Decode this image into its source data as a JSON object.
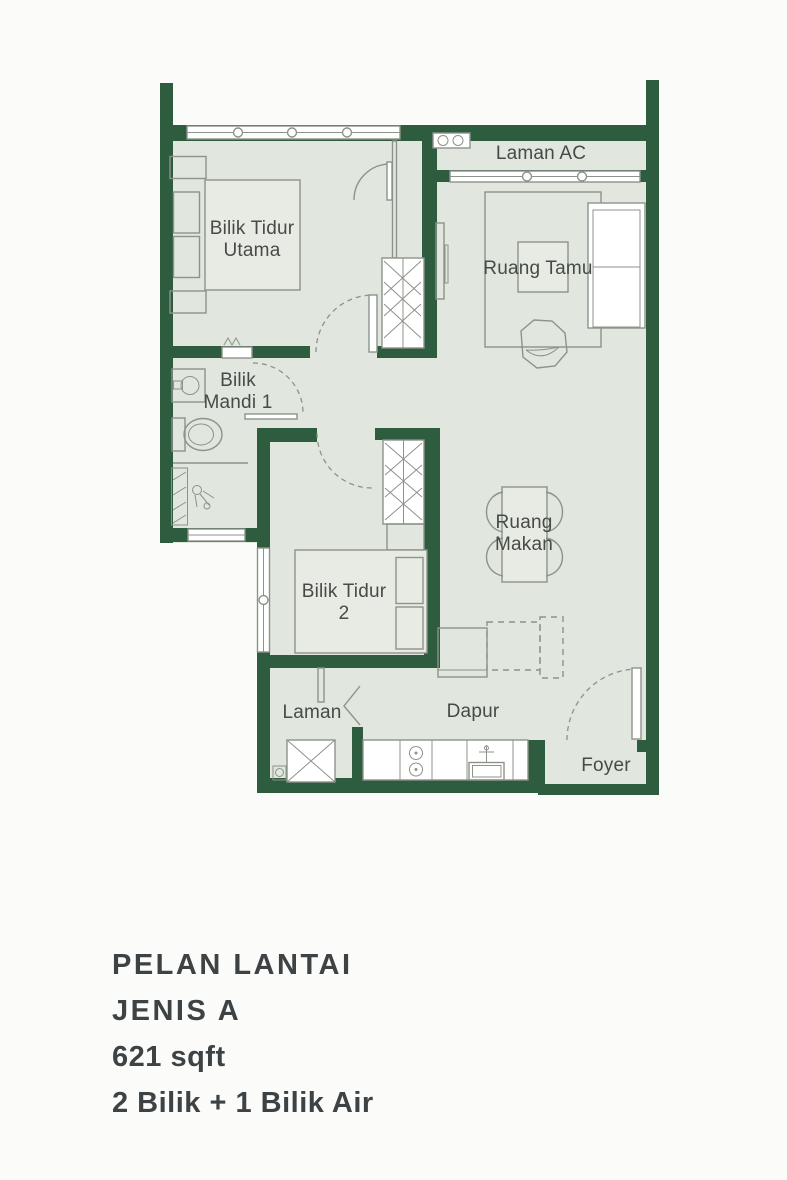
{
  "plan": {
    "rooms": [
      {
        "id": "bilik-tidur-utama",
        "label": "Bilik Tidur\nUtama"
      },
      {
        "id": "laman-ac",
        "label": "Laman AC"
      },
      {
        "id": "ruang-tamu",
        "label": "Ruang Tamu"
      },
      {
        "id": "bilik-mandi-1",
        "label": "Bilik\nMandi 1"
      },
      {
        "id": "ruang-makan",
        "label": "Ruang\nMakan"
      },
      {
        "id": "bilik-tidur-2",
        "label": "Bilik Tidur\n2"
      },
      {
        "id": "laman",
        "label": "Laman"
      },
      {
        "id": "dapur",
        "label": "Dapur"
      },
      {
        "id": "foyer",
        "label": "Foyer"
      }
    ],
    "colors": {
      "wall": "#2d5c3f",
      "floor": "#e1e6de",
      "outside": "#fbfcfa",
      "line": "#8c938a",
      "label": "#454c46",
      "caption": "#3d4245"
    }
  },
  "caption": {
    "title": "PELAN LANTAI",
    "type": "JENIS A",
    "area": "621 sqft",
    "config": "2 Bilik + 1 Bilik Air"
  }
}
